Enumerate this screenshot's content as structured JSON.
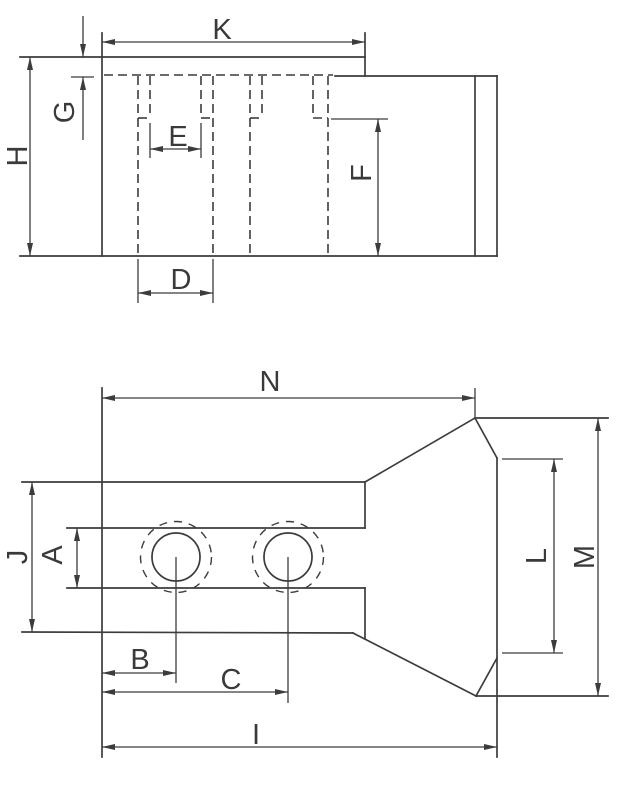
{
  "drawing": {
    "kind": "technical-drawing",
    "background": "#ffffff",
    "line_color": "#3c3c3c",
    "side_view": {
      "labels": {
        "K": "K",
        "G": "G",
        "H": "H",
        "E": "E",
        "F": "F",
        "D": "D"
      }
    },
    "plan_view": {
      "labels": {
        "N": "N",
        "J": "J",
        "A": "A",
        "L": "L",
        "M": "M",
        "B": "B",
        "C": "C",
        "I": "I"
      }
    }
  }
}
